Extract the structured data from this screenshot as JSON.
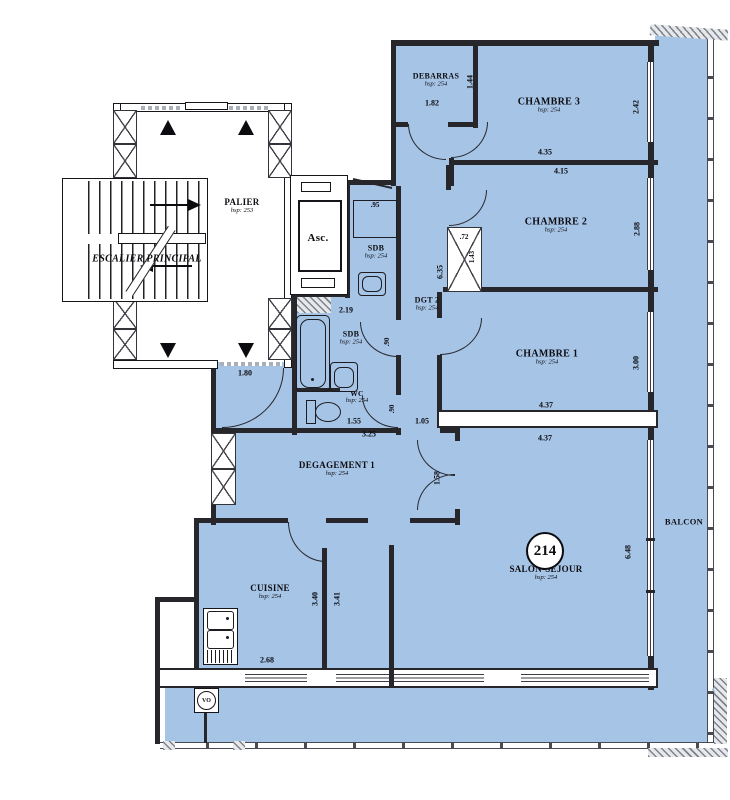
{
  "meta": {
    "apartment_number": "214"
  },
  "colors": {
    "floor_fill": "#a6c4e6",
    "wall": "#26262b",
    "paper": "#ffffff"
  },
  "rooms": {
    "palier": {
      "label": "PALIER",
      "sub": "hsp: 253"
    },
    "escalier": {
      "label": "ESCALIER PRINCIPAL"
    },
    "asc": {
      "label": "Asc."
    },
    "debarras": {
      "label": "DEBARRAS",
      "sub": "hsp: 254"
    },
    "chambre3": {
      "label": "CHAMBRE 3",
      "sub": "hsp: 254"
    },
    "chambre2": {
      "label": "CHAMBRE 2",
      "sub": "hsp: 254"
    },
    "chambre1": {
      "label": "CHAMBRE 1",
      "sub": "hsp: 254"
    },
    "sdb_haut": {
      "label": "SDB",
      "sub": "hsp: 254"
    },
    "dgt2": {
      "label": "DGT 2",
      "sub": "hsp: 254"
    },
    "sdb": {
      "label": "SDB",
      "sub": "hsp: 254"
    },
    "wc": {
      "label": "WC",
      "sub": "hsp: 254"
    },
    "degagement1": {
      "label": "DEGAGEMENT 1",
      "sub": "hsp: 254"
    },
    "cuisine": {
      "label": "CUISINE",
      "sub": "hsp: 254"
    },
    "salon": {
      "label": "SALON-SEJOUR",
      "sub": "hsp: 254"
    },
    "balcon": {
      "label": "BALCON"
    },
    "vo": {
      "label": "VO"
    }
  },
  "dims": {
    "deb_w": "1.82",
    "deb_h": "1.44",
    "c3_w": "4.35",
    "c3_h": "2.42",
    "c2_w": "4.15",
    "c2_h": "2.88",
    "shaft_w": ".72",
    "shaft_h": "1.43",
    "dgt_h": "6.35",
    "niche": ".95",
    "sdb_w": "2.19",
    "sdb_door": ".90",
    "wc_door": ".90",
    "c1_h": "3.00",
    "c1_w_in": "4.37",
    "c1_w_out": "4.37",
    "wc_w": "1.55",
    "wc_d": "1.05",
    "bains_w": "3.25",
    "entree": "1.80",
    "deg_door": "1.58",
    "cui_h": "3.40",
    "nook_h": "3.41",
    "cui_w": "2.68",
    "salon_h": "6.48"
  }
}
